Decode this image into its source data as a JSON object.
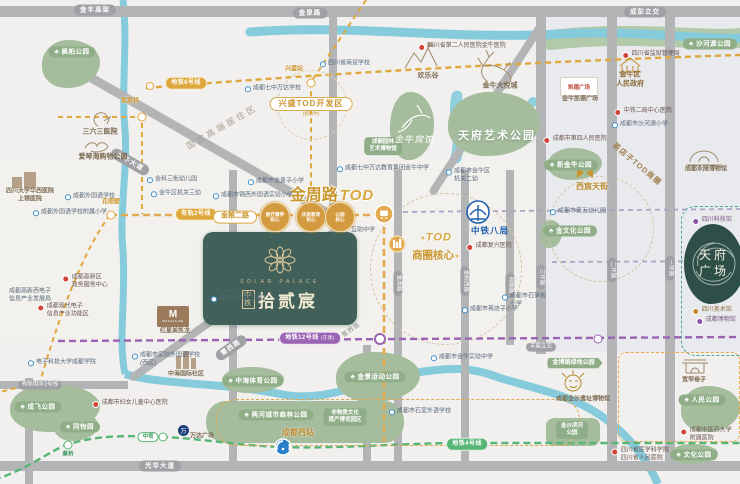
{
  "project": {
    "brand_prefix": "中铁",
    "name_cn": "拾贰宸",
    "name_en": "SOLAR PALACE"
  },
  "headline": {
    "road": "金周路",
    "tod": "TOD",
    "badge": "兴盛TOD开发区",
    "badge_note": "(规划中)",
    "core_line1": "TOD",
    "core_line2": "商圈核心",
    "sparkle": "✦"
  },
  "crec": {
    "label": "中铁八局"
  },
  "tianfu_square": {
    "line1": "天府",
    "line2": "广场"
  },
  "colors": {
    "gold_accent": "#c9952c",
    "tram_gold": "#dfa83d",
    "metro12_purple": "#9a63b3",
    "metro4_green": "#57b576",
    "park_green": "#a5bd9d",
    "project_green": "#41605a",
    "river_blue": "#85cbdb",
    "crec_blue": "#1f5fae",
    "road_gray": "#b3b4b6"
  },
  "metro": {
    "line_pills": [
      {
        "text": "地铁6号线",
        "color": "gold",
        "x": 186,
        "y": 83
      },
      {
        "text": "有轨2号线",
        "color": "gold",
        "x": 196,
        "y": 214
      },
      {
        "text": "地铁12号线",
        "note": "(在建)",
        "color": "purple",
        "x": 310,
        "y": 338
      },
      {
        "text": "地铁4号线",
        "color": "green",
        "x": 467,
        "y": 444
      }
    ],
    "station_labels": [
      {
        "text": "金粮二路",
        "kind": "stl-gold-pill",
        "x": 235,
        "y": 217
      },
      {
        "text": "侯家桥",
        "kind": "stl-gold-text",
        "x": 130,
        "y": 102
      },
      {
        "text": "兴盛站",
        "kind": "stl-gold-text",
        "x": 294,
        "y": 70
      },
      {
        "text": "花照壁",
        "kind": "stl-gold-text",
        "x": 111,
        "y": 203
      },
      {
        "text": "中坝",
        "kind": "stl-green-pill",
        "x": 148,
        "y": 437
      },
      {
        "text": "蔡桥",
        "kind": "stl-green-text",
        "x": 68,
        "y": 455
      }
    ],
    "tod_circles": [
      {
        "lines": [
          "医疗康养",
          "核心"
        ],
        "x": 275,
        "y": 217
      },
      {
        "lines": [
          "优质教育",
          "核心"
        ],
        "x": 311,
        "y": 217
      },
      {
        "lines": [
          "公园",
          "核心"
        ],
        "x": 340,
        "y": 217
      }
    ]
  },
  "road_labels": [
    {
      "text": "金丰高架",
      "kind": "rl-pill",
      "x": 95,
      "y": 10
    },
    {
      "text": "金泉路",
      "kind": "rl-pill",
      "x": 310,
      "y": 13
    },
    {
      "text": "成彭立交",
      "kind": "rl-pill",
      "x": 645,
      "y": 12
    },
    {
      "text": "金牛大道",
      "kind": "rl-pill",
      "x": 130,
      "y": 162,
      "rot": 30
    },
    {
      "text": "蜀西路",
      "kind": "rl-pill",
      "x": 231,
      "y": 348,
      "rot": -35
    },
    {
      "text": "蜀西路",
      "kind": "rl-plain",
      "x": 352,
      "y": 331,
      "rot": -35
    },
    {
      "text": "光华大道",
      "kind": "rl-pill",
      "x": 160,
      "y": 466
    },
    {
      "text": "有轨电车2号线",
      "kind": "rl-pill-sm",
      "x": 40,
      "y": 385
    },
    {
      "text": "羊犀立交",
      "kind": "rl-pill-sm",
      "x": 541,
      "y": 347
    },
    {
      "text": "金周路",
      "kind": "rl-pill-sm",
      "x": 398,
      "y": 283,
      "rot": 90
    },
    {
      "text": "金科西路",
      "kind": "rl-pill-sm",
      "x": 465,
      "y": 281,
      "rot": 90
    },
    {
      "text": "同和路",
      "kind": "rl-pill-sm",
      "x": 510,
      "y": 285,
      "rot": 90
    },
    {
      "text": "三环路",
      "kind": "rl-pill-sm",
      "x": 541,
      "y": 277,
      "rot": 90
    },
    {
      "text": "二环路",
      "kind": "rl-pill-sm",
      "x": 612,
      "y": 270,
      "rot": 90
    },
    {
      "text": "一环路",
      "kind": "rl-pill-sm",
      "x": 670,
      "y": 268,
      "rot": 90
    }
  ],
  "pois": [
    {
      "dot": "blue",
      "x": 90,
      "y": 197,
      "lines": [
        "成都外国语学校"
      ]
    },
    {
      "dot": "blue",
      "x": 70,
      "y": 213,
      "lines": [
        "成都外国语学校附属小学"
      ]
    },
    {
      "dot": "blue",
      "x": 273,
      "y": 89,
      "lines": [
        "成都七中万达学校"
      ]
    },
    {
      "dot": "blue",
      "x": 345,
      "y": 64,
      "lines": [
        "四川省商贸学校"
      ]
    },
    {
      "dot": "blue",
      "x": 383,
      "y": 169,
      "lines": [
        "成都七中万达教育集团金牛中学"
      ]
    },
    {
      "dot": "blue",
      "x": 276,
      "y": 182,
      "lines": [
        "成都市金贵子小学"
      ]
    },
    {
      "dot": "blue",
      "x": 253,
      "y": 196,
      "lines": [
        "成都市锦西外国语实验小学"
      ]
    },
    {
      "dot": "blue",
      "x": 172,
      "y": 180,
      "lines": [
        "金科三街幼儿园"
      ]
    },
    {
      "dot": "blue",
      "x": 176,
      "y": 194,
      "lines": [
        "金牛区机关三幼"
      ]
    },
    {
      "dot": "blue",
      "x": 640,
      "y": 125,
      "lines": [
        "成都市沙河源小学"
      ]
    },
    {
      "dot": "blue",
      "x": 578,
      "y": 212,
      "lines": [
        "成都市第五幼儿园"
      ]
    },
    {
      "dot": "blue",
      "x": 490,
      "y": 310,
      "lines": [
        "成都市茶店子小学"
      ]
    },
    {
      "dot": "blue",
      "x": 524,
      "y": 301,
      "lines": [
        "成都市石笋街",
        "小学"
      ]
    },
    {
      "dot": "blue",
      "x": 468,
      "y": 176,
      "lines": [
        "成都市金牛区",
        "机关二幼"
      ]
    },
    {
      "dot": "blue",
      "x": 62,
      "y": 363,
      "lines": [
        "电子科技大学成都学院"
      ]
    },
    {
      "dot": "blue",
      "x": 166,
      "y": 360,
      "lines": [
        "成都市实验外国语学校",
        "(西区)"
      ]
    },
    {
      "dot": "blue",
      "x": 238,
      "y": 299,
      "lines": [
        "茶店子小学(北区)"
      ]
    },
    {
      "dot": "blue",
      "x": 462,
      "y": 358,
      "lines": [
        "成都市金牛实验中学"
      ]
    },
    {
      "dot": "blue",
      "x": 420,
      "y": 412,
      "lines": [
        "成都市石室外语学校"
      ]
    },
    {
      "dot": "red",
      "x": 462,
      "y": 47,
      "lines": [
        "四川省第二人民医院金牛医院"
      ]
    },
    {
      "dot": "red",
      "x": 651,
      "y": 55,
      "lines": [
        "四川省监狱管理局"
      ]
    },
    {
      "dot": "red",
      "x": 643,
      "y": 112,
      "lines": [
        "中铁二局中心医院"
      ]
    },
    {
      "dot": "red",
      "x": 575,
      "y": 140,
      "lines": [
        "成都市第四人民医院"
      ]
    },
    {
      "dot": "red",
      "x": 489,
      "y": 247,
      "lines": [
        "成都复兴医院"
      ]
    },
    {
      "dot": "red",
      "x": 130,
      "y": 404,
      "lines": [
        "成都市妇女儿童中心医院"
      ]
    },
    {
      "dot": "red",
      "x": 640,
      "y": 455,
      "lines": [
        "四川省医学科学院",
        "四川省人民医院"
      ]
    },
    {
      "dot": "red",
      "x": 706,
      "y": 435,
      "lines": [
        "成都中医药大学",
        "附属医院"
      ]
    },
    {
      "dot": "red",
      "x": 85,
      "y": 282,
      "lines": [
        "成都高新区",
        "政务服务中心"
      ]
    },
    {
      "dot": "red",
      "x": 63,
      "y": 311,
      "lines": [
        "成都现代电子",
        "信息产业功能区"
      ]
    },
    {
      "dot": "purple",
      "x": 712,
      "y": 221,
      "lines": [
        "四川科技馆"
      ]
    },
    {
      "dot": "purple",
      "x": 716,
      "y": 321,
      "lines": [
        "成都博物馆"
      ]
    },
    {
      "dot": "gold",
      "x": 712,
      "y": 311,
      "lines": [
        "四川美术馆"
      ]
    },
    {
      "dot": "none",
      "x": 30,
      "y": 296,
      "lines": [
        "成都高新西电子",
        "信息产业发展局"
      ]
    },
    {
      "dot": "none",
      "x": 363,
      "y": 231,
      "lines": [
        "互助中学"
      ]
    }
  ],
  "park_labels": [
    {
      "text": "枫桕公园",
      "kind": "pkl-pill",
      "x": 72,
      "y": 52
    },
    {
      "text": "天府艺术公园",
      "kind": "pkl-white",
      "x": 497,
      "y": 137
    },
    {
      "lines": [
        "成都园林",
        "艺术博物馆"
      ],
      "kind": "pkl-badge",
      "x": 383,
      "y": 146
    },
    {
      "text": "新金牛公园",
      "kind": "pkl-pill",
      "x": 571,
      "y": 165
    },
    {
      "text": "金文化公园",
      "kind": "pkl-pill",
      "x": 570,
      "y": 231
    },
    {
      "text": "沙河源公园",
      "kind": "pkl-pill",
      "x": 710,
      "y": 44
    },
    {
      "text": "人民公园",
      "kind": "pkl-pill",
      "x": 702,
      "y": 400
    },
    {
      "text": "文化公园",
      "kind": "pkl-pill",
      "x": 694,
      "y": 455
    },
    {
      "text": "金博路绿地公园",
      "kind": "pkl-arrow",
      "x": 575,
      "y": 363
    },
    {
      "lines": [
        "金沙滨河",
        "公园"
      ],
      "kind": "pkl-badge",
      "x": 572,
      "y": 430
    },
    {
      "text": "两河城市森林公园",
      "kind": "pkl-pill",
      "x": 276,
      "y": 415
    },
    {
      "lines": [
        "非物质文化",
        "遗产博览园区"
      ],
      "kind": "pkl-badge",
      "x": 345,
      "y": 417
    },
    {
      "text": "金景运动公园",
      "kind": "pkl-pill",
      "x": 375,
      "y": 377
    },
    {
      "text": "中海体育公园",
      "kind": "pkl-pill",
      "x": 253,
      "y": 381
    },
    {
      "text": "成飞公园",
      "kind": "pkl-pill",
      "x": 38,
      "y": 407
    },
    {
      "text": "同怡园",
      "kind": "pkl-pill",
      "x": 80,
      "y": 427
    },
    {
      "text": "金牛宾馆",
      "kind": "pkl-script",
      "x": 414,
      "y": 140
    }
  ],
  "landmarks": [
    {
      "text": "三六三医院",
      "kind": "lm",
      "x": 100,
      "y": 133
    },
    {
      "text": "爱琴海购物公园",
      "kind": "lm",
      "x": 103,
      "y": 158
    },
    {
      "text": "金牛大悦城",
      "kind": "lm",
      "x": 500,
      "y": 87
    },
    {
      "text": "欢乐谷",
      "kind": "lm",
      "x": 428,
      "y": 77
    },
    {
      "text": "金牛凯德广场",
      "kind": "lm-sm",
      "x": 580,
      "y": 100
    },
    {
      "text": "成都永陵博物馆",
      "kind": "lm-sm",
      "x": 706,
      "y": 170
    },
    {
      "text": "西宸天街",
      "kind": "lm-gold",
      "x": 592,
      "y": 187
    },
    {
      "text": "成都金沙遗址博物馆",
      "kind": "lm-sm",
      "x": 583,
      "y": 400
    },
    {
      "text": "宽窄巷子",
      "kind": "lm-sm",
      "x": 694,
      "y": 381
    },
    {
      "text": "成都西站",
      "kind": "lm-gold",
      "x": 298,
      "y": 433
    },
    {
      "text": "万达广场",
      "kind": "lm-sm",
      "x": 202,
      "y": 437
    },
    {
      "text": "中海国际社区",
      "kind": "lm-sm",
      "x": 186,
      "y": 375
    },
    {
      "text": "红星美凯龙",
      "kind": "lm-sm",
      "x": 175,
      "y": 332
    },
    {
      "lines": [
        "四川大学华西医院",
        "上锦医院"
      ],
      "kind": "lm-sm",
      "x": 30,
      "y": 196
    },
    {
      "lines": [
        "金牛区",
        "人民政府"
      ],
      "kind": "lm-gov",
      "x": 630,
      "y": 80
    }
  ],
  "zones": [
    {
      "text": "国宾高端居住区",
      "kind": "zone",
      "x": 222,
      "y": 127,
      "rot": -30
    },
    {
      "text": "茶店子TOD商圈",
      "kind": "zone2",
      "x": 637,
      "y": 164,
      "rot": 40
    }
  ],
  "boxes": {
    "kaide": "凯德广场",
    "macalline_m": "M",
    "macalline_s": "MACALLINE",
    "wanda": "万"
  }
}
